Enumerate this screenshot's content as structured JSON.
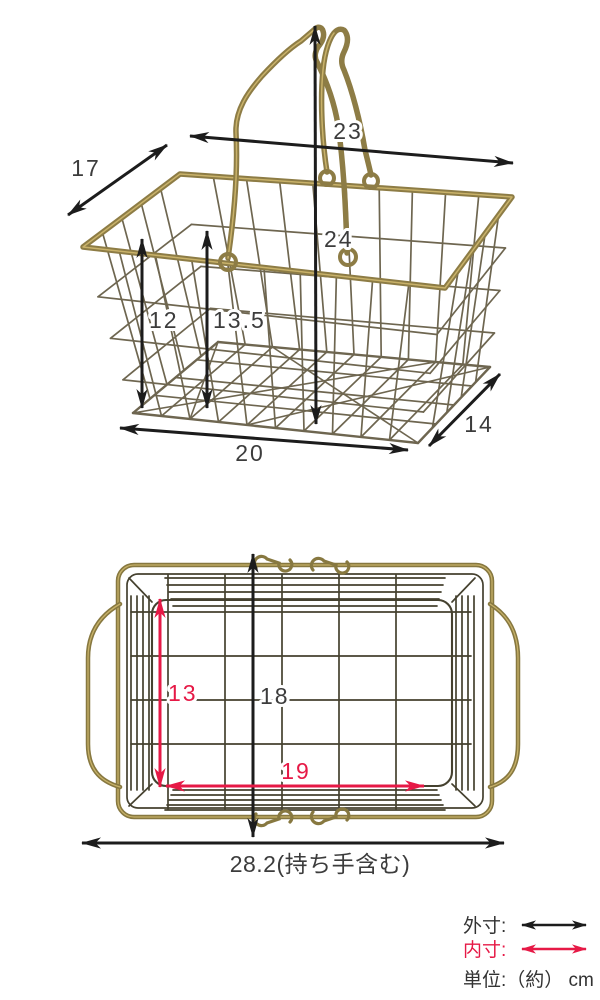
{
  "colors": {
    "outer_dimension": "#1c1c1c",
    "inner_dimension": "#e61946",
    "number_text": "#3c3c3c",
    "basket_brass": "#8d7c45",
    "wire": "#6e6650"
  },
  "perspective_view": {
    "top_width": "23",
    "top_depth": "17",
    "total_height": "24",
    "left_height": "12",
    "center_height": "13.5",
    "bottom_width": "20",
    "bottom_depth": "14"
  },
  "top_view": {
    "outer_depth": "18",
    "inner_depth": "13",
    "inner_width": "19",
    "outer_width": "28.2(持ち手含む)"
  },
  "legend": {
    "outer_label": "外寸:",
    "inner_label": "内寸:",
    "unit_label": "単位:（約） cm"
  }
}
